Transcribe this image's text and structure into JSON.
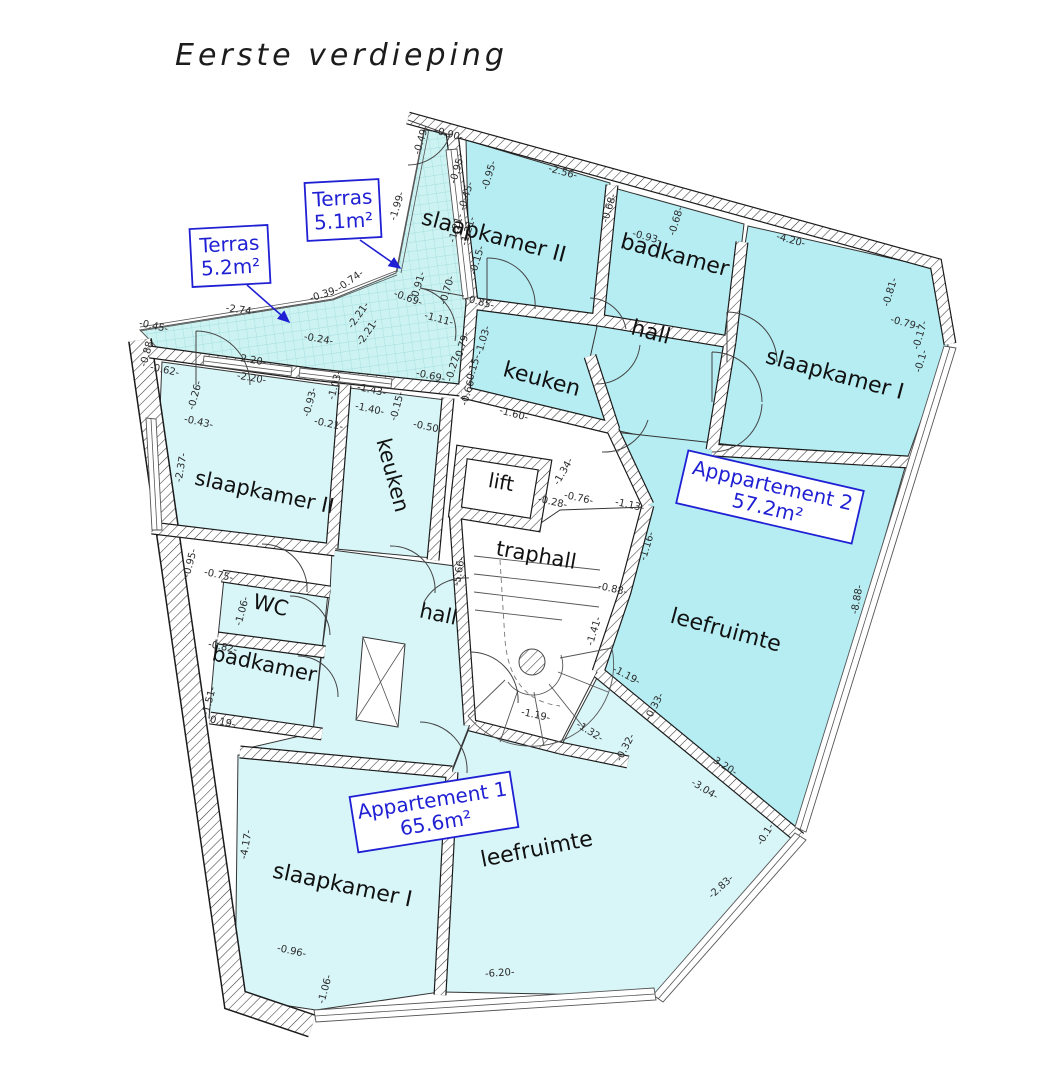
{
  "title": "Eerste verdieping",
  "colors": {
    "apartment1_fill": "#d8f5f8",
    "apartment2_fill": "#b5edf3",
    "terrace_fill": "#cdf2f2",
    "annotation_blue": "#1f1fd4",
    "wall_line": "#1b1b1b",
    "dimension_text": "#2b2b2b"
  },
  "rooms": [
    {
      "label": "slaapkamer II",
      "x": 492,
      "y": 243,
      "r": 15,
      "s": 22
    },
    {
      "label": "badkamer",
      "x": 673,
      "y": 262,
      "r": 15,
      "s": 22
    },
    {
      "label": "hall",
      "x": 649,
      "y": 339,
      "r": 15,
      "s": 22
    },
    {
      "label": "keuken",
      "x": 540,
      "y": 386,
      "r": 15,
      "s": 22
    },
    {
      "label": "slaapkamer I",
      "x": 833,
      "y": 381,
      "r": 15,
      "s": 22
    },
    {
      "label": "leefruimte",
      "x": 724,
      "y": 637,
      "r": 15,
      "s": 22
    },
    {
      "label": "slaapkamer II",
      "x": 263,
      "y": 499,
      "r": 12,
      "s": 21
    },
    {
      "label": "keuken",
      "x": 386,
      "y": 477,
      "r": 75,
      "s": 21
    },
    {
      "label": "lift",
      "x": 500,
      "y": 489,
      "r": 10,
      "s": 20
    },
    {
      "label": "traphall",
      "x": 535,
      "y": 562,
      "r": 10,
      "s": 21
    },
    {
      "label": "hall",
      "x": 437,
      "y": 621,
      "r": 12,
      "s": 21
    },
    {
      "label": "WC",
      "x": 269,
      "y": 612,
      "r": 14,
      "s": 21
    },
    {
      "label": "badkamer",
      "x": 263,
      "y": 671,
      "r": 12,
      "s": 21
    },
    {
      "label": "slaapkamer I",
      "x": 341,
      "y": 892,
      "r": 12,
      "s": 22
    },
    {
      "label": "leefruimte",
      "x": 538,
      "y": 856,
      "r": -11,
      "s": 22
    }
  ],
  "annotations": [
    {
      "lines": [
        "Terras",
        "5.2m²"
      ],
      "cx": 230,
      "cy": 256,
      "w": 78,
      "h": 58,
      "rot": -3,
      "arrow": [
        247,
        285,
        289,
        322
      ]
    },
    {
      "lines": [
        "Terras",
        "5.1m²"
      ],
      "cx": 343,
      "cy": 210,
      "w": 74,
      "h": 58,
      "rot": -3,
      "arrow": [
        360,
        240,
        400,
        268
      ]
    },
    {
      "lines": [
        "Apppartement 2",
        "57.2m²"
      ],
      "cx": 770,
      "cy": 497,
      "w": 180,
      "h": 54,
      "rot": 13
    },
    {
      "lines": [
        "Appartement 1",
        "65.6m²"
      ],
      "cx": 434,
      "cy": 812,
      "w": 162,
      "h": 56,
      "rot": -9
    }
  ],
  "dimensions": [
    [
      "-0.49-",
      424,
      141,
      -73
    ],
    [
      "-0.90-",
      448,
      137,
      15
    ],
    [
      "-1.99-",
      400,
      207,
      -73
    ],
    [
      "-0.95-",
      460,
      170,
      -73
    ],
    [
      "-0.45-",
      469,
      197,
      -73
    ],
    [
      "-0.95-",
      492,
      176,
      -73
    ],
    [
      "-1.21-",
      459,
      229,
      -73
    ],
    [
      "-1.21-",
      471,
      232,
      -73
    ],
    [
      "-0.15-",
      480,
      261,
      -73
    ],
    [
      "-0.91-",
      421,
      287,
      -73
    ],
    [
      "-0.70-",
      450,
      291,
      -73
    ],
    [
      "-0.85-",
      479,
      305,
      15
    ],
    [
      "-2.56-",
      562,
      175,
      15
    ],
    [
      "-0.68-",
      612,
      209,
      -73
    ],
    [
      "-0.93-",
      646,
      240,
      15
    ],
    [
      "-0.68-",
      679,
      222,
      -73
    ],
    [
      "-4.20-",
      790,
      243,
      15
    ],
    [
      "-0.81-",
      893,
      293,
      -73
    ],
    [
      "-0.79-",
      904,
      326,
      15
    ],
    [
      "-0.17-",
      923,
      336,
      -73
    ],
    [
      "-0.1-",
      924,
      362,
      -73
    ],
    [
      "-1.03-",
      486,
      341,
      -73
    ],
    [
      "-0.79-",
      465,
      347,
      -73
    ],
    [
      "-0.27-",
      456,
      368,
      -73
    ],
    [
      "-0.15-",
      476,
      370,
      -73
    ],
    [
      "-0.66-",
      471,
      392,
      -73
    ],
    [
      "-1.60-",
      513,
      417,
      15
    ],
    [
      "-1.11-",
      438,
      322,
      15
    ],
    [
      "-0.69-",
      407,
      301,
      20
    ],
    [
      "-2.21-",
      361,
      317,
      -55
    ],
    [
      "-2.21-",
      370,
      334,
      -55
    ],
    [
      "-0.39-",
      325,
      297,
      -18
    ],
    [
      "-0.74-",
      352,
      283,
      -35
    ],
    [
      "-2.74-",
      240,
      313,
      8
    ],
    [
      "-0.24-",
      318,
      342,
      10
    ],
    [
      "-0.45-",
      153,
      329,
      12
    ],
    [
      "-0.88-",
      150,
      353,
      -75
    ],
    [
      "-0.62-",
      164,
      373,
      12
    ],
    [
      "-2.20-",
      251,
      363,
      10
    ],
    [
      "-2.20-",
      251,
      381,
      10
    ],
    [
      "-0.26-",
      198,
      396,
      -75
    ],
    [
      "-0.93-",
      313,
      403,
      -75
    ],
    [
      "-1.03-",
      338,
      386,
      -75
    ],
    [
      "-1.43-",
      371,
      393,
      12
    ],
    [
      "-1.40-",
      369,
      412,
      12
    ],
    [
      "-0.15-",
      400,
      407,
      -75
    ],
    [
      "-0.50-",
      427,
      430,
      12
    ],
    [
      "-0.69-",
      430,
      379,
      12
    ],
    [
      "-0.43-",
      198,
      425,
      12
    ],
    [
      "-2.37-",
      184,
      468,
      -80
    ],
    [
      "-0.21-",
      328,
      427,
      12
    ],
    [
      "-0.95-",
      193,
      564,
      -75
    ],
    [
      "-0.75-",
      218,
      578,
      12
    ],
    [
      "-1.06-",
      245,
      612,
      -75
    ],
    [
      "-0.82-",
      222,
      650,
      12
    ],
    [
      "-1.51-",
      212,
      702,
      -75
    ],
    [
      "0.19-",
      222,
      725,
      12
    ],
    [
      "-4.17-",
      249,
      845,
      -80
    ],
    [
      "-0.96-",
      291,
      954,
      12
    ],
    [
      "-1.06-",
      328,
      990,
      -75
    ],
    [
      "-6.20-",
      500,
      976,
      -4
    ],
    [
      "-5.66-",
      462,
      572,
      -80
    ],
    [
      "-1.34-",
      566,
      473,
      -60
    ],
    [
      "-0.28-",
      552,
      505,
      12
    ],
    [
      "-0.76-",
      578,
      501,
      12
    ],
    [
      "-1.13-",
      629,
      508,
      12
    ],
    [
      "-1.16-",
      650,
      547,
      -73
    ],
    [
      "-0.88-",
      612,
      592,
      12
    ],
    [
      "-1.41-",
      597,
      632,
      -73
    ],
    [
      "-1.19-",
      625,
      678,
      28
    ],
    [
      "-0.33-",
      657,
      708,
      -62
    ],
    [
      "-1.19-",
      535,
      718,
      12
    ],
    [
      "-1.32-",
      588,
      734,
      32
    ],
    [
      "-0.32-",
      628,
      749,
      -62
    ],
    [
      "-3.20-",
      722,
      768,
      32
    ],
    [
      "-3.04-",
      703,
      792,
      32
    ],
    [
      "-0.1-",
      768,
      836,
      -58
    ],
    [
      "-2.83-",
      723,
      889,
      -42
    ],
    [
      "-8.88-",
      860,
      600,
      -80
    ]
  ]
}
